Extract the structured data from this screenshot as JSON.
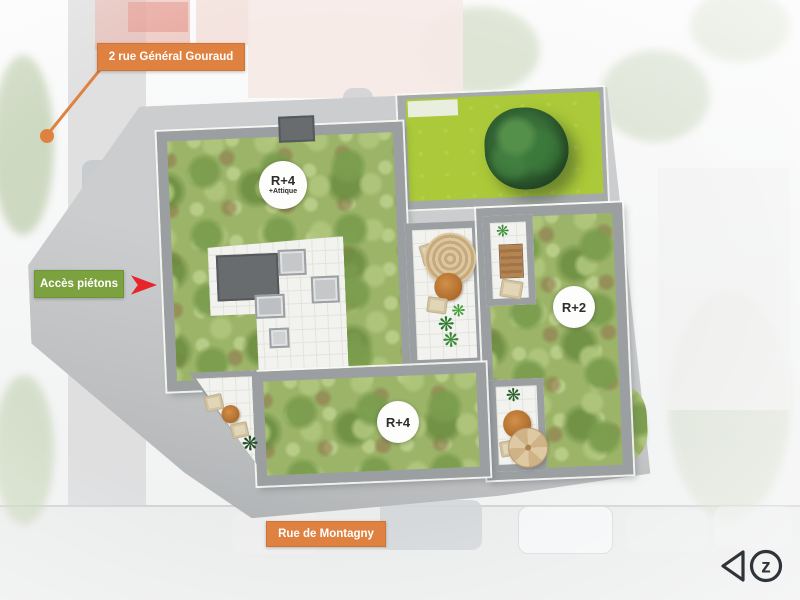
{
  "annotations": {
    "street_label_top": "2 rue Général Gouraud",
    "pedestrian_access_label": "Accès piétons",
    "street_label_bottom": "Rue de Montagny"
  },
  "buildings": [
    {
      "name": "main-building",
      "storeys": "R+4",
      "storeys_extra": "+Attique"
    },
    {
      "name": "east-building",
      "storeys": "R+2",
      "storeys_extra": ""
    },
    {
      "name": "south-building",
      "storeys": "R+4",
      "storeys_extra": ""
    }
  ],
  "logo": {
    "mark": "z"
  },
  "icons": {
    "plant_glyph": "❋",
    "access_arrow": "arrowhead-right-icon"
  },
  "colors": {
    "label_orange": "#df8140",
    "label_green": "#7ba23e",
    "arrow_red": "#e8242b",
    "lawn_green": "#abc938",
    "garden_green": "#9cb468",
    "wall_grey": "#9b9fa2",
    "ground_grey": "#c3c5c7",
    "paving_white": "#f2f2ef",
    "logo_dark": "#30343a"
  }
}
